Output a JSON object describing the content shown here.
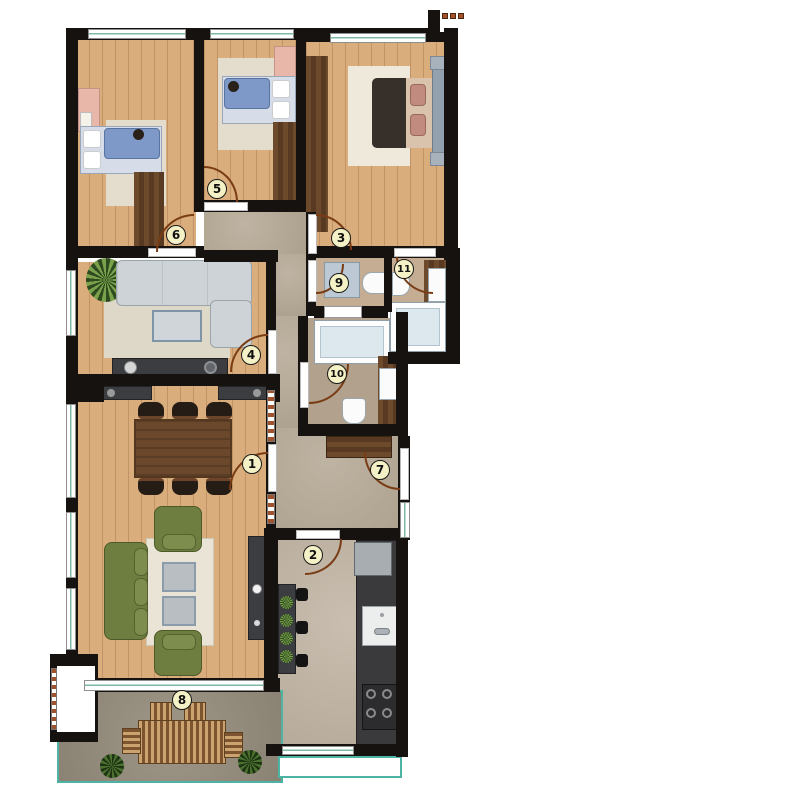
{
  "scene": "apartment-floor-plan",
  "markers": [
    {
      "number": "1",
      "x": 252,
      "y": 464
    },
    {
      "number": "2",
      "x": 313,
      "y": 555
    },
    {
      "number": "3",
      "x": 341,
      "y": 238
    },
    {
      "number": "4",
      "x": 251,
      "y": 355
    },
    {
      "number": "5",
      "x": 217,
      "y": 189
    },
    {
      "number": "6",
      "x": 176,
      "y": 235
    },
    {
      "number": "7",
      "x": 380,
      "y": 470
    },
    {
      "number": "8",
      "x": 182,
      "y": 700
    },
    {
      "number": "9",
      "x": 339,
      "y": 283
    },
    {
      "number": "10",
      "x": 337,
      "y": 374
    },
    {
      "number": "11",
      "x": 404,
      "y": 269
    }
  ],
  "palette": {
    "wall": "#161210",
    "wood_floor": "#d9ad7c",
    "dark_wood": "#6e4a2c",
    "stone_floor": "#b6a996",
    "balcony_floor": "#968d7d",
    "marker_fill": "#f4f1c6",
    "door_arc": "#7a3c15",
    "window_teal": "#7fb9a5",
    "balcony_rail_teal": "#4db3a2",
    "sofa_gray": "#cdd3d6",
    "sofa_green": "#6e7e40",
    "bed_blanket_blue": "#7e99c8",
    "rug_cream": "#e4ddcd",
    "counter_dark": "#3b3d41"
  }
}
